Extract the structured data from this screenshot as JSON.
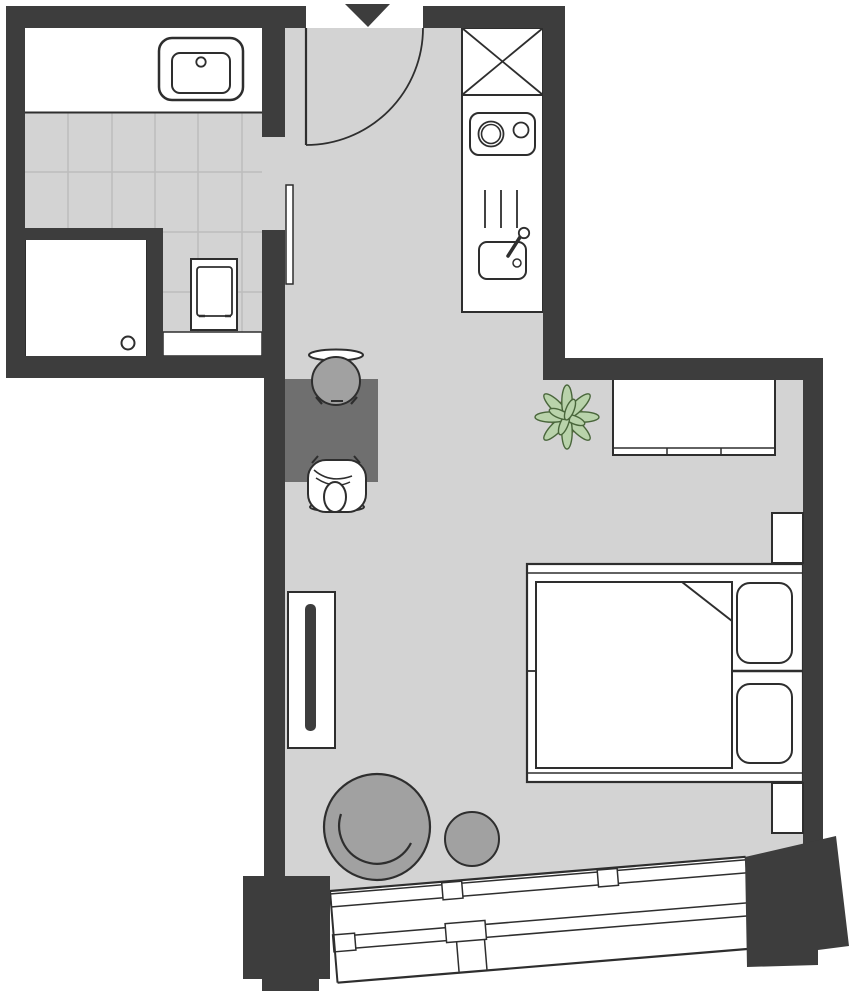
{
  "meta": {
    "type": "apartment-floor-plan",
    "width_px": 858,
    "height_px": 1000,
    "visible_text": ""
  },
  "colors": {
    "wall": "#3d3d3d",
    "floor": "#d3d3d3",
    "tile": "#bdbdbd",
    "outline": "#2e2e2e",
    "desk": "#6f6f6f",
    "seat": "#a1a1a1",
    "leaf": "#b9d3ab",
    "leafline": "#49663b",
    "plant_center": "#c0aa84",
    "fixture_fill": "#ffffff"
  },
  "rooms": {
    "bathroom": {
      "position": "top-left",
      "fixtures": [
        "vanity-counter",
        "wash-basin",
        "tiled-floor",
        "shower",
        "toilet",
        "toilet-shelf"
      ]
    },
    "hallway": {
      "position": "top-center",
      "features": [
        "entrance-opening",
        "entrance-direction-triangle",
        "entrance-door-swing",
        "bathroom-door-leaf"
      ]
    },
    "kitchen": {
      "position": "top-right-strip",
      "fixtures": [
        "tall-cabinet-x",
        "cooktop-two-burners",
        "vent-lines",
        "kitchen-sink-with-faucet"
      ]
    },
    "living_sleeping_area": {
      "position": "center-bottom",
      "furniture": [
        "desk",
        "desk-chair-empty",
        "desk-chair-person",
        "wardrobe-with-sliding-door",
        "sideboard",
        "potted-plant",
        "double-bed",
        "pillow-upper",
        "pillow-lower",
        "wall-niche-upper",
        "wall-niche-lower",
        "armchair-round",
        "side-table-round",
        "window-band-tilted",
        "window-pillar-left",
        "window-pillar-right"
      ]
    }
  }
}
